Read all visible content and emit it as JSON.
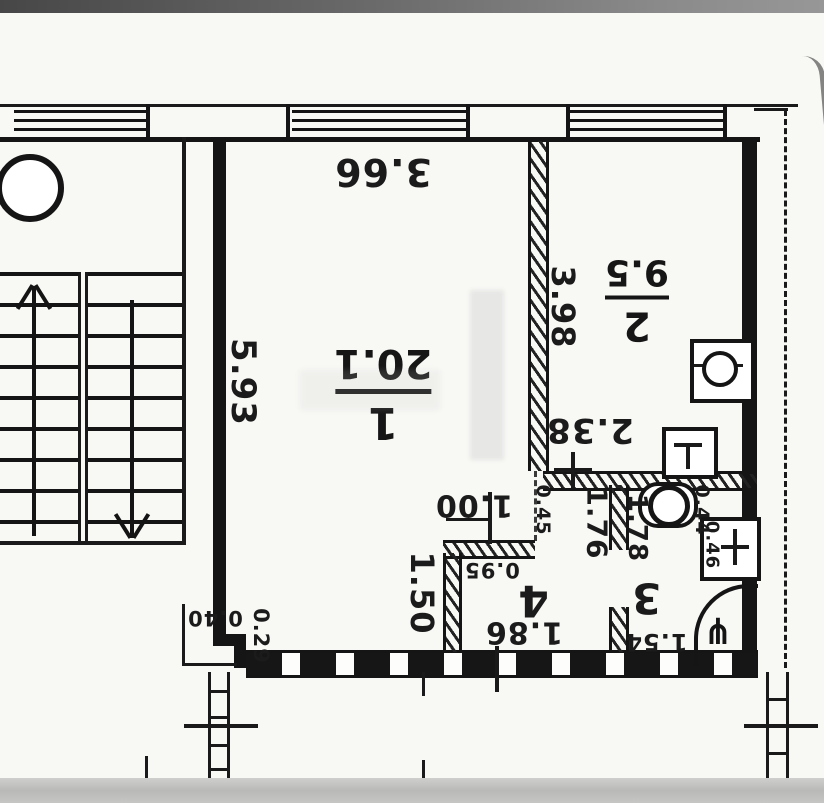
{
  "floorplan": {
    "rooms": {
      "room1": {
        "number": "1",
        "area": "20.1"
      },
      "room2": {
        "number": "2",
        "area": "9.5"
      },
      "room3": {
        "number": "3"
      },
      "room4": {
        "number": "4"
      }
    },
    "dimensions": {
      "room1_width": "3.66",
      "room1_length": "5.93",
      "door_opening": "1.00",
      "room1_recess": "1.50",
      "corner_w": "0.40",
      "corner_h": "0.29",
      "room2_length": "3.98",
      "room2_lower": "2.38",
      "hall_top": "0.95",
      "hall_bottom": "1.86",
      "hall_length": "1.76",
      "wall_stub": "0.45",
      "bath_length": "1.78",
      "bath_width": "1.54",
      "wc_width": "0.44",
      "duct_width": "0.46"
    },
    "icons": {
      "shower_glyph": "⋔"
    }
  }
}
